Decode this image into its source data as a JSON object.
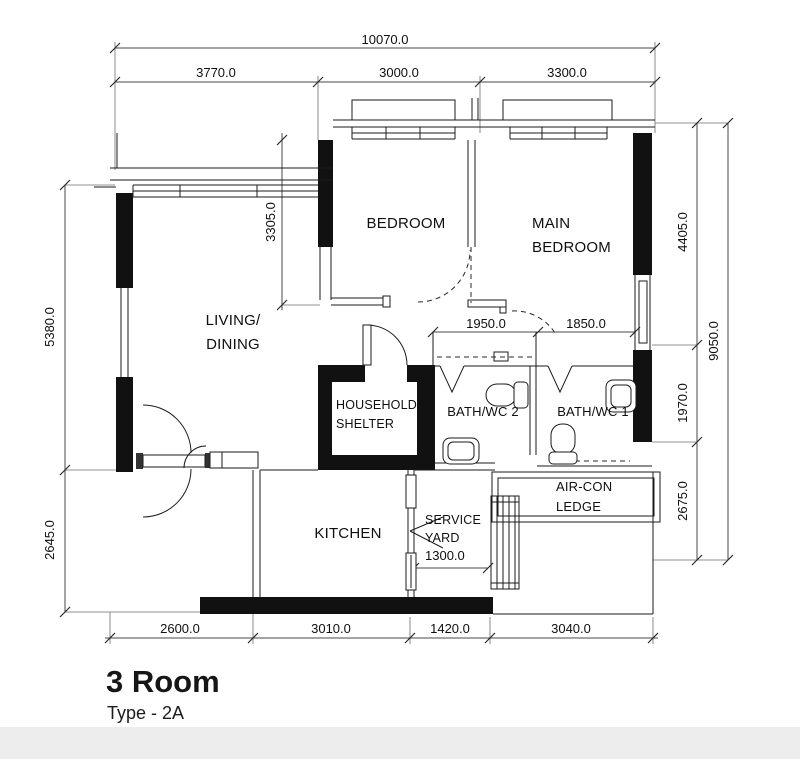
{
  "document": {
    "type_label": "3 Room",
    "variant_label": "Type - 2A"
  },
  "rooms": {
    "living_line1": "LIVING/",
    "living_line2": "DINING",
    "bedroom": "BEDROOM",
    "main_bedroom_line1": "MAIN",
    "main_bedroom_line2": "BEDROOM",
    "kitchen": "KITCHEN",
    "bath2": "BATH/WC 2",
    "bath1": "BATH/WC 1",
    "household_shelter_line1": "HOUSEHOLD",
    "household_shelter_line2": "SHELTER",
    "aircon_line1": "AIR-CON",
    "aircon_line2": "LEDGE",
    "service_yard_line1": "SERVICE",
    "service_yard_line2": "YARD"
  },
  "dimensions": {
    "top_total": "10070.0",
    "top_segments": [
      "3770.0",
      "3000.0",
      "3300.0"
    ],
    "left_segments": [
      "5380.0",
      "2645.0"
    ],
    "right_segments": [
      "4405.0",
      "1970.0",
      "2675.0"
    ],
    "right_total": "9050.0",
    "bottom_segments": [
      "2600.0",
      "3010.0",
      "1420.0",
      "3040.0"
    ],
    "bedroom_depth": "3305.0",
    "corridor_widths": [
      "1950.0",
      "1850.0"
    ],
    "service_yard_width": "1300.0"
  },
  "colors": {
    "wall_fill": "#111111",
    "line": "#1b1b1b",
    "dim_line": "#4a4a4a",
    "background": "#ffffff",
    "footer_strip": "#ededed"
  }
}
